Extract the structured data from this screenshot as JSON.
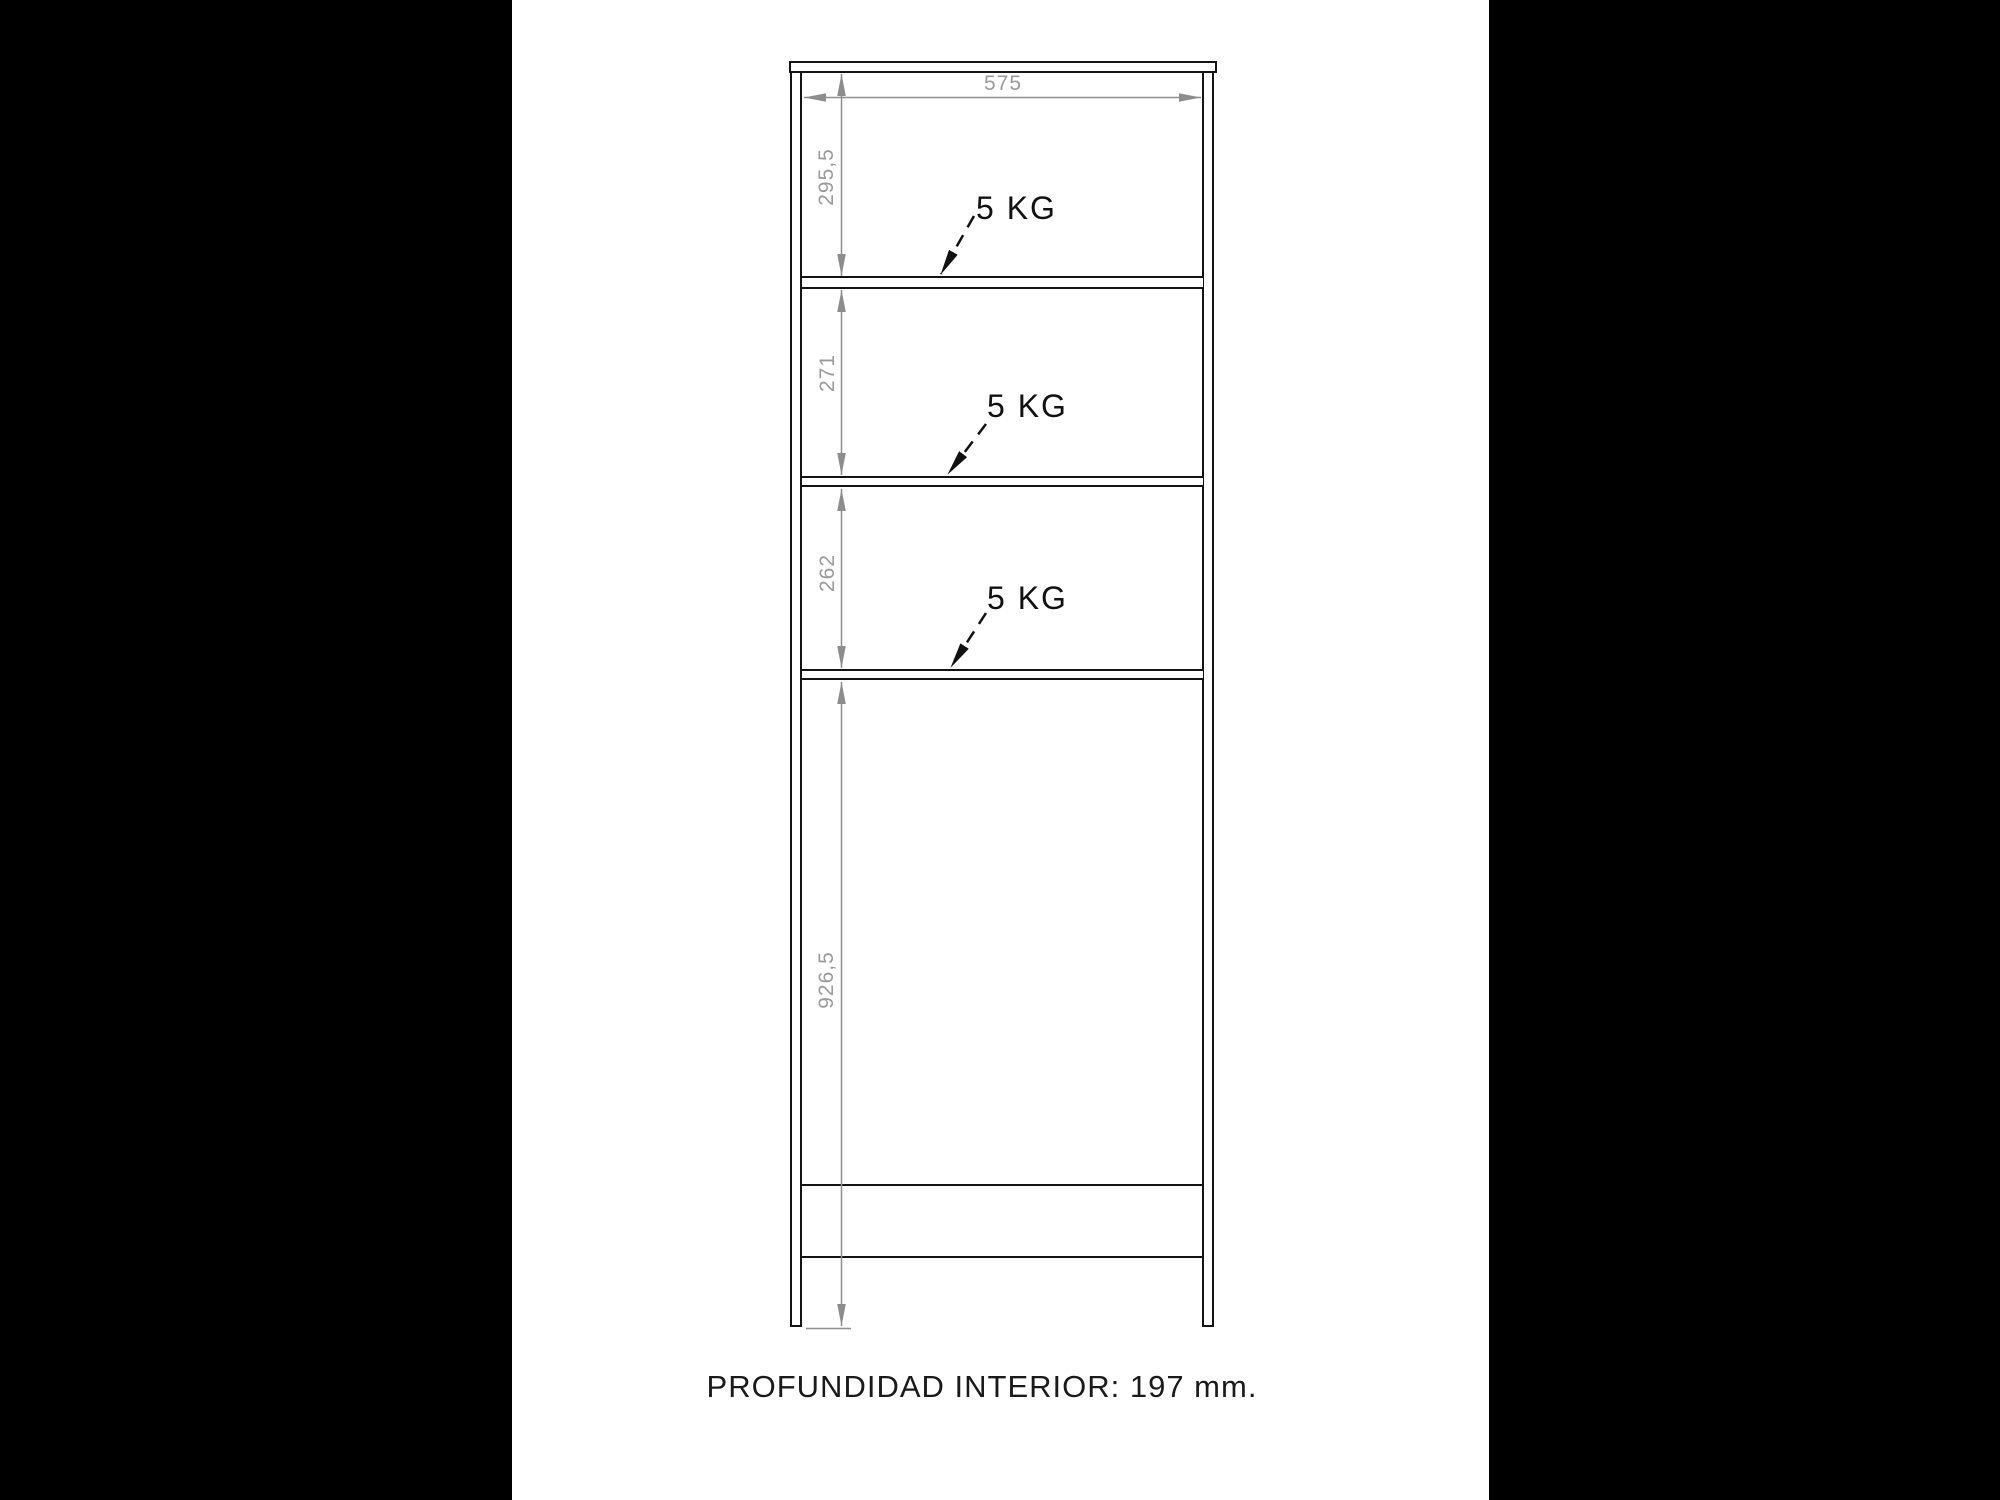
{
  "diagram": {
    "dim_width": "575",
    "dim_heights": {
      "section1": "295,5",
      "section2": "271",
      "section3": "262",
      "section4": "926,5"
    },
    "load_labels": [
      {
        "text": "5 KG"
      },
      {
        "text": "5 KG"
      },
      {
        "text": "5 KG"
      }
    ],
    "footer_text": "PROFUNDIDAD INTERIOR: 197 mm.",
    "colors": {
      "matte_bars": "#000000",
      "canvas": "#ffffff",
      "drawing_lines": "#141414",
      "dimension_lines": "#8d8d8d",
      "dimension_text": "#9a9a9a",
      "load_text": "#111111"
    }
  }
}
